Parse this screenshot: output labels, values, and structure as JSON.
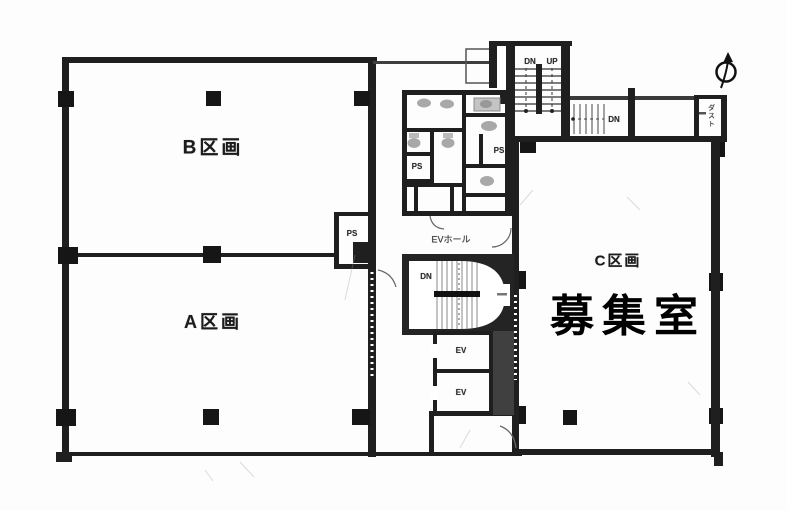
{
  "labels": {
    "section_b": "B区画",
    "section_a": "A区画",
    "section_c": "C区画",
    "vacancy": "募集室",
    "ev_hall": "EVホール",
    "stair_top_down": "DN",
    "stair_top_up": "UP",
    "stair_east_down": "DN",
    "stair_core_down": "DN",
    "elevator_1": "EV",
    "elevator_2": "EV",
    "pipe_space_ab": "PS",
    "pipe_space_west": "PS",
    "pipe_space_east": "PS",
    "duct_space": "ダスト"
  },
  "icons": {
    "north_arrow": "compass-north-arrow"
  },
  "colors": {
    "wall": "#1f1f1f",
    "ink": "#222222",
    "paper": "#fdfdfd",
    "fixture": "#a8a8a8"
  }
}
